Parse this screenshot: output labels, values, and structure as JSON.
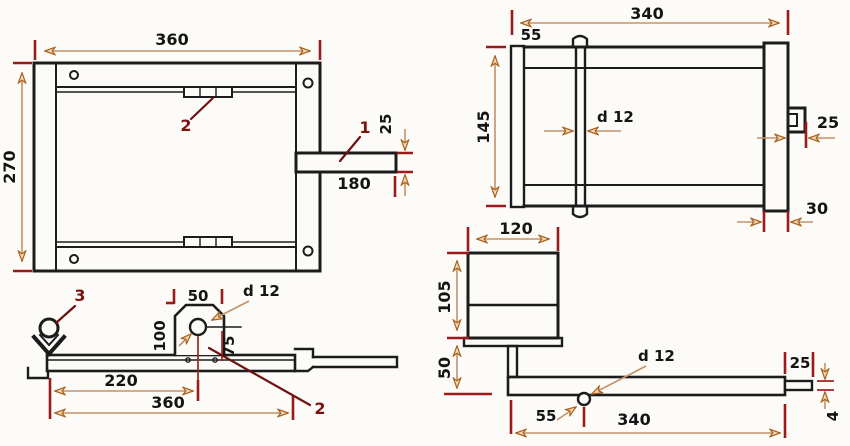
{
  "drawing_type": "technical-dimension-drawing",
  "views": {
    "frame_plan": {
      "width": "360",
      "height": "270",
      "handle_height": "25",
      "handle_length": "180",
      "label_handle": "1",
      "label_clip": "2"
    },
    "frame_top": {
      "width": "340",
      "rod_offset": "55",
      "height": "145",
      "rod_diameter": "d 12",
      "handle_end_width": "25",
      "side_bar_width": "30"
    },
    "bar_side": {
      "tab_width": "50",
      "hole_diameter": "d 12",
      "tab_height": "100",
      "hole_height": "75",
      "hole_offset": "220",
      "length": "360",
      "label_latch": "3",
      "label_tab": "2"
    },
    "assembly_side": {
      "box_width": "120",
      "box_height": "105",
      "post_height": "50",
      "hole_offset": "55",
      "hole_diameter": "d 12",
      "length": "340",
      "pin_length": "25",
      "pin_thickness": "4"
    }
  },
  "colors": {
    "background": "#fcfbf8",
    "linework": "#1c1c1c",
    "dimension_line": "#c49268",
    "arrow_fill": "#f0d9b5",
    "arrow_stroke": "#a8601e",
    "extension_tick": "#9b1b1b",
    "part_label": "#7a1212",
    "dimension_text": "#141414"
  }
}
